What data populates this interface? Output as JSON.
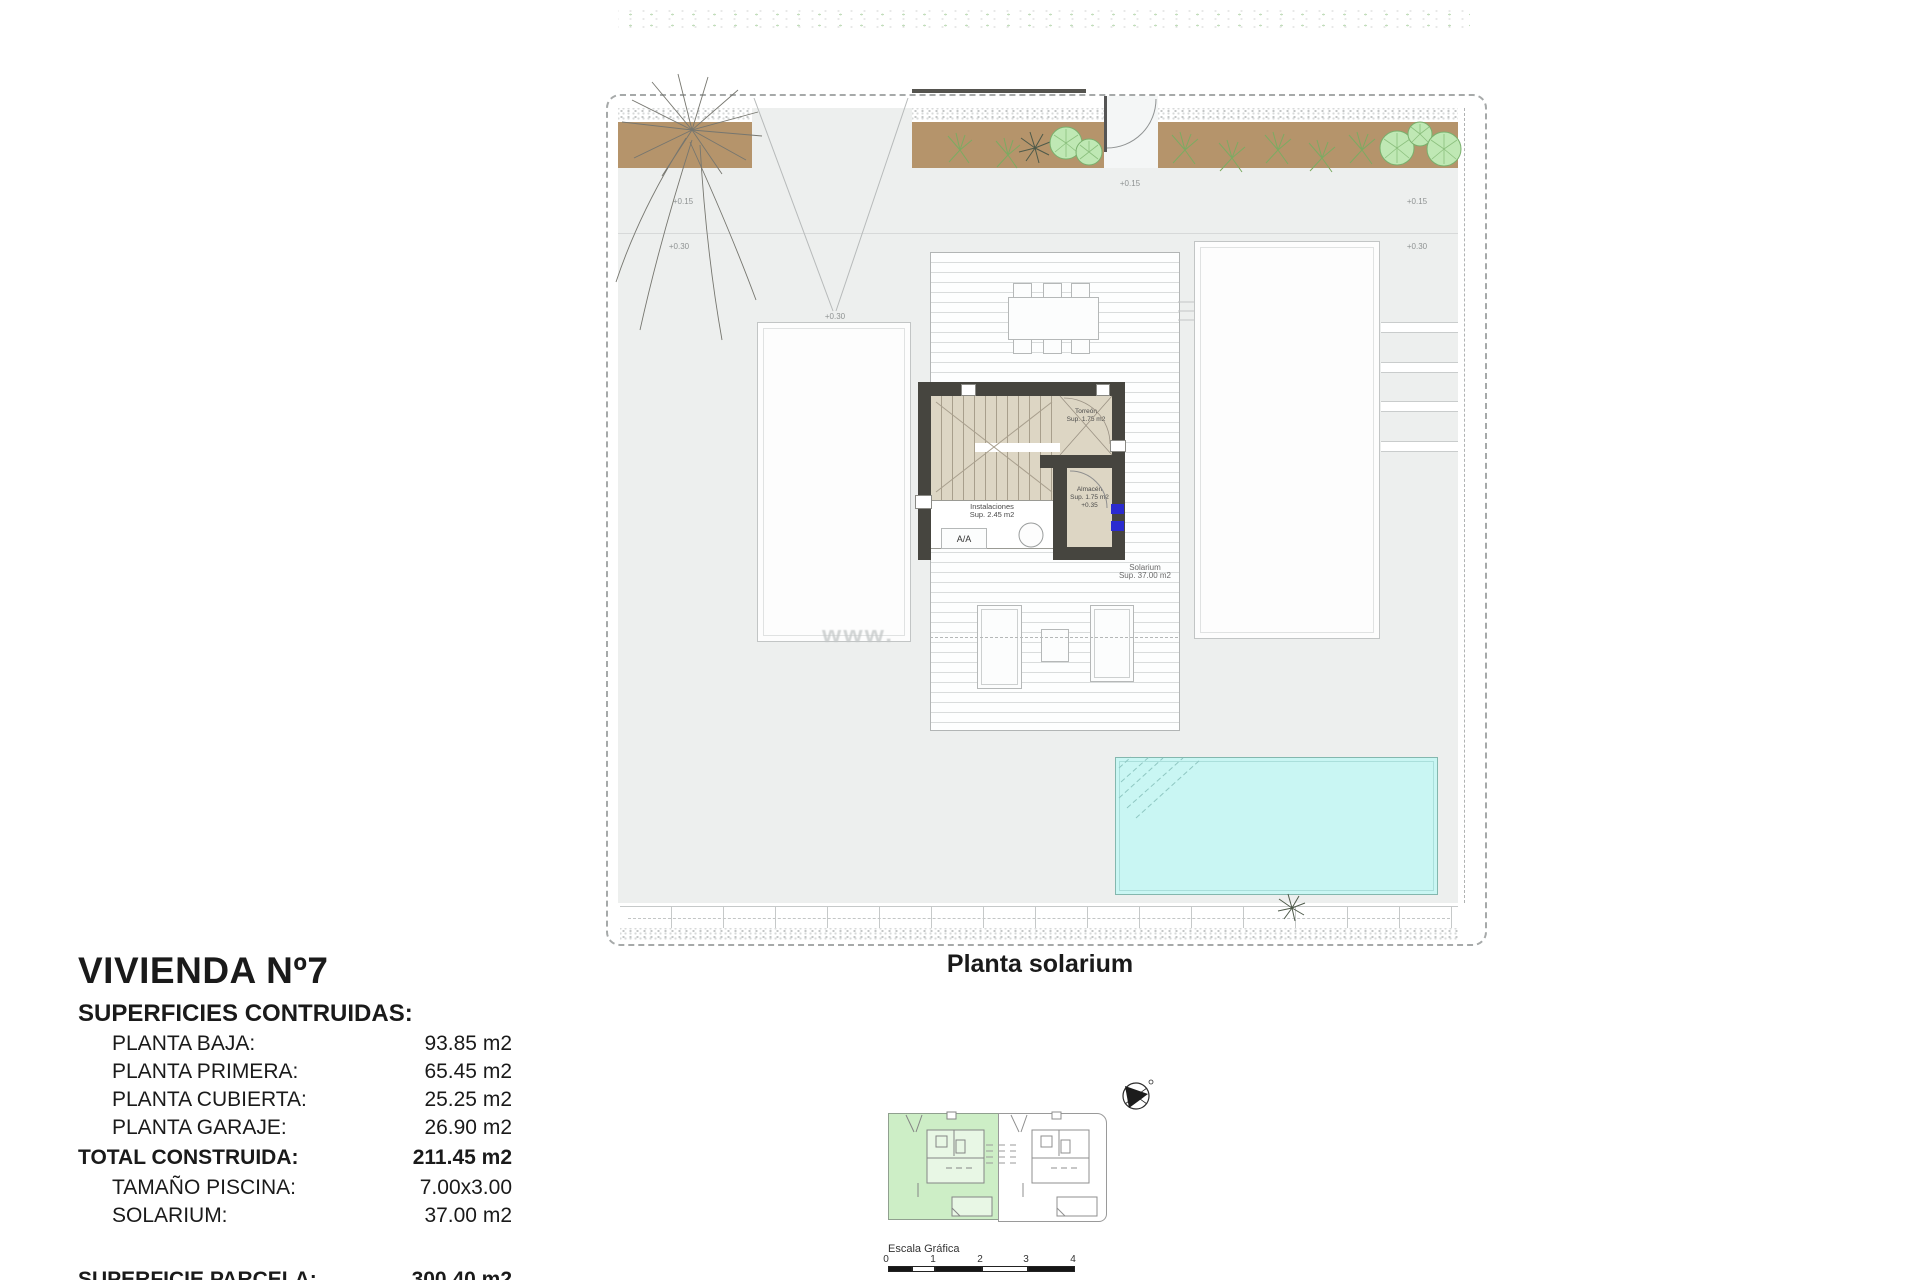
{
  "caption": "Planta solarium",
  "watermark": "www.",
  "plan": {
    "levels": {
      "tl_015": "+0.15",
      "tl_030": "+0.30",
      "drive_030": "+0.30",
      "gate_015": "+0.15",
      "tr_015": "+0.15",
      "tr_030": "+0.30"
    },
    "rooms": {
      "torreon": {
        "name": "Torreón",
        "area": "Sup. 1.75 m2"
      },
      "almacen": {
        "name": "Almacén",
        "area": "Sup. 1.75 m2",
        "level": "+0.35"
      },
      "instalaciones": {
        "name": "Instalaciones",
        "area": "Sup. 2.45 m2",
        "ac": "A/A"
      },
      "solarium": {
        "name": "Solarium",
        "area": "Sup. 37.00 m2"
      }
    }
  },
  "title_block": {
    "title": "VIVIENDA Nº7",
    "subtitle": "SUPERFICIES CONTRUIDAS:",
    "rows": [
      {
        "label": "PLANTA BAJA:",
        "value": "93.85 m2"
      },
      {
        "label": "PLANTA PRIMERA:",
        "value": "65.45 m2"
      },
      {
        "label": "PLANTA CUBIERTA:",
        "value": "25.25 m2"
      },
      {
        "label": "PLANTA GARAJE:",
        "value": "26.90 m2"
      },
      {
        "label": "TOTAL CONSTRUIDA:",
        "value": "211.45 m2"
      },
      {
        "label": "TAMAÑO PISCINA:",
        "value": "7.00x3.00"
      },
      {
        "label": "SOLARIUM:",
        "value": "37.00 m2"
      }
    ],
    "parcel_row": {
      "label": "SUPERFICIE PARCELA:",
      "value": "300.40 m2"
    }
  },
  "keyplan": {
    "scale_label": "Escala Gráfica",
    "ticks": [
      "0",
      "1",
      "2",
      "3",
      "4"
    ]
  },
  "colors": {
    "plot_bg": "#edefee",
    "planting": "#b5946b",
    "pool": "#c9f6f3",
    "wall": "#46453f",
    "stair_floor": "#ddd6c4",
    "keyplan_highlight": "#cdeec6",
    "window_blue": "#2b2bd0"
  }
}
